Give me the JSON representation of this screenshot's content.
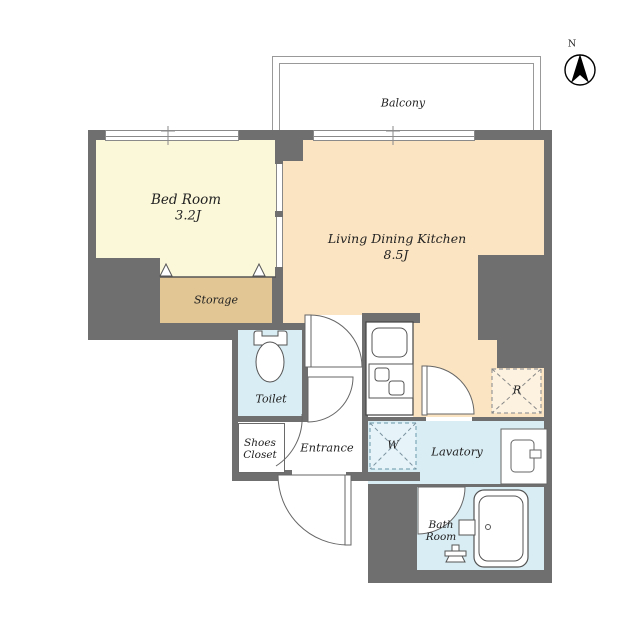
{
  "title": "Apartment floor plan",
  "colors": {
    "wall": "#6f6f6f",
    "bedroom": "#fbf8d9",
    "ldk": "#fbe4c1",
    "storage": "#e2c694",
    "water": "#d9edf4",
    "line": "#555555",
    "thin": "#999999",
    "ink": "#222222"
  },
  "compass": {
    "north_label": "N"
  },
  "balcony": {
    "label": "Balcony"
  },
  "rooms": {
    "bedroom": {
      "name": "Bed Room",
      "size": "3.2J"
    },
    "ldk": {
      "name": "Living Dining Kitchen",
      "size": "8.5J"
    },
    "storage": {
      "name": "Storage"
    },
    "toilet": {
      "name": "Toilet"
    },
    "shoes_closet": {
      "line1": "Shoes",
      "line2": "Closet"
    },
    "entrance": {
      "name": "Entrance"
    },
    "lavatory": {
      "name": "Lavatory"
    },
    "bath": {
      "line1": "Bath",
      "line2": "Room"
    },
    "washer": {
      "label": "W"
    },
    "refrigerator": {
      "label": "R"
    }
  }
}
